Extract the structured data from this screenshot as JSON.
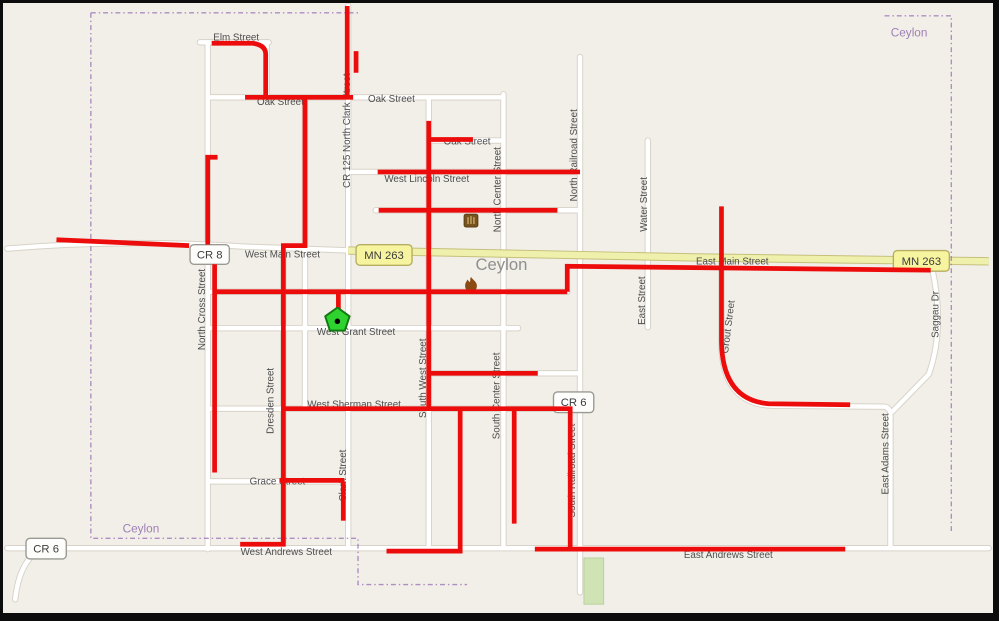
{
  "map": {
    "colors": {
      "land": "#f2efe9",
      "road_fill": "#ffffff",
      "road_casing": "#d8d3c8",
      "highway_fill": "#eef0ab",
      "highway_casing": "#c6c07c",
      "route_overlay": "#ed0c0c",
      "boundary": "#a07cb8",
      "street_label": "#4d4d4d",
      "city_label": "#8f8f8f",
      "admin_label": "#9d80b5",
      "park_fill": "#cfe3b4",
      "park_stroke": "#b9d19b",
      "shield_county_fill": "#fdfdfb",
      "shield_county_stroke": "#9a9a92",
      "shield_state_fill": "#f7f4a0",
      "shield_state_stroke": "#b5ae62",
      "shield_text": "#3c3c3c",
      "marker_fill": "#2fd32f",
      "marker_stroke": "#117a11",
      "fire_icon_color": "#8a4a12",
      "library_icon_color": "#76531e"
    },
    "roads": [
      "M204,40 L204,556",
      "M264,40 L264,97",
      "M281,248 L281,554",
      "M303,96 L303,412",
      "M347,3 L347,554",
      "M429,96 L429,557",
      "M505,93 L505,554",
      "M583,55 L583,600",
      "M652,140 L652,330",
      "M727,265 L727,345 Q727,409 780,410 L893,411 Q899,412 899,420 L899,554",
      "M941,268 Q955,330 938,378 L901,416",
      "M196,40 L266,40",
      "M204,96 L505,96",
      "M429,140 L505,140",
      "M347,172 L583,172",
      "M375,211 L583,211",
      "M204,294 L570,294",
      "M204,331 L520,331",
      "M429,377 L583,377",
      "M204,413 L583,413",
      "M204,487 L347,487",
      "M0,555 L999,555",
      "M0,250 Q120,240 240,248 L352,252",
      "M8,607 Q12,570 32,557"
    ],
    "highways": [
      "M347,252 L700,259 L999,263"
    ],
    "boundary_paths": [
      "M85,10 L357,10",
      "M85,10 L85,545 L357,545 L357,592 L468,592",
      "M893,13 L961,13 L961,540"
    ],
    "route_segments": [
      "M208,41 L250,41 Q263,43 263,52 L263,95",
      "M346,3 L346,97",
      "M355,49 L355,71",
      "M242,96 L352,96",
      "M303,96 L303,247 L281,247 L281,551 L237,551",
      "M429,120 L429,414",
      "M430,139 L474,139",
      "M377,172 L583,172",
      "M378,211 L560,211",
      "M214,157 L204,157 L204,246",
      "M50,241 L185,247",
      "M213,294 L570,294",
      "M211,266 L211,478",
      "M337,294 L337,314",
      "M430,377 L540,377",
      "M280,413 L573,413 L573,554",
      "M516,414 L516,530",
      "M461,414 L461,558 L386,558",
      "M277,486 L343,486",
      "M342,487 L342,527",
      "M570,294 L570,268 L940,272",
      "M727,207 L727,345 Q728,404 775,408 L858,409",
      "M537,556 L853,556"
    ],
    "shields": [
      {
        "label": "CR 8",
        "x": 186,
        "y": 246,
        "w": 40,
        "h": 20,
        "kind": "county"
      },
      {
        "label": "MN 263",
        "x": 355,
        "y": 246,
        "w": 57,
        "h": 21,
        "kind": "state"
      },
      {
        "label": "CR 6",
        "x": 556,
        "y": 396,
        "w": 41,
        "h": 21,
        "kind": "county"
      },
      {
        "label": "CR 6",
        "x": 19,
        "y": 545,
        "w": 41,
        "h": 21,
        "kind": "county"
      },
      {
        "label": "MN 263",
        "x": 902,
        "y": 252,
        "w": 57,
        "h": 21,
        "kind": "state"
      }
    ],
    "street_labels_h": [
      {
        "t": "Elm Street",
        "x": 233,
        "y": 38
      },
      {
        "t": "Oak Street",
        "x": 278,
        "y": 104
      },
      {
        "t": "Oak Street",
        "x": 391,
        "y": 101
      },
      {
        "t": "Oak Street",
        "x": 468,
        "y": 144
      },
      {
        "t": "West Lincoln Street",
        "x": 427,
        "y": 182
      },
      {
        "t": "West Main Street",
        "x": 280,
        "y": 259
      },
      {
        "t": "East Main Street",
        "x": 738,
        "y": 266
      },
      {
        "t": "West Grant Street",
        "x": 355,
        "y": 338
      },
      {
        "t": "West Sherman Street",
        "x": 353,
        "y": 412
      },
      {
        "t": "Grace Street",
        "x": 275,
        "y": 490
      },
      {
        "t": "West Andrews Street",
        "x": 284,
        "y": 562
      },
      {
        "t": "East Andrews Street",
        "x": 734,
        "y": 565
      }
    ],
    "street_labels_v": [
      {
        "t": "North Cross Street",
        "x": 201,
        "y": 312
      },
      {
        "t": "Dresden Street",
        "x": 271,
        "y": 405
      },
      {
        "t": "CR 125  North Clark Street",
        "x": 349,
        "y": 130
      },
      {
        "t": "South West Street",
        "x": 426,
        "y": 382
      },
      {
        "t": "North Center Street",
        "x": 502,
        "y": 190
      },
      {
        "t": "South Center Street",
        "x": 501,
        "y": 400
      },
      {
        "t": "North Railroad Street",
        "x": 580,
        "y": 155
      },
      {
        "t": "South Railroad Street",
        "x": 578,
        "y": 476
      },
      {
        "t": "Water Street",
        "x": 651,
        "y": 205
      },
      {
        "t": "East Street",
        "x": 649,
        "y": 303
      },
      {
        "t": "Clark Street",
        "x": 345,
        "y": 481
      },
      {
        "t": "East Adams Street",
        "x": 897,
        "y": 459
      },
      {
        "t": "Saggau Dr",
        "x": 948,
        "y": 317
      },
      {
        "t": "Grout Street",
        "x": 737,
        "y": 330,
        "rot": -83
      }
    ],
    "place_labels": [
      {
        "t": "Ceylon",
        "x": 503,
        "y": 272,
        "kind": "city"
      },
      {
        "t": "Ceylon",
        "x": 918,
        "y": 34,
        "kind": "admin"
      },
      {
        "t": "Ceylon",
        "x": 136,
        "y": 539,
        "kind": "admin"
      }
    ],
    "park": {
      "x": 587,
      "y": 565,
      "w": 20,
      "h": 47
    },
    "markers": {
      "pentagon": {
        "cx": 336,
        "cy": 323,
        "r": 13
      },
      "fire": {
        "x": 472,
        "y": 287
      },
      "library": {
        "x": 472,
        "y": 222
      }
    }
  }
}
